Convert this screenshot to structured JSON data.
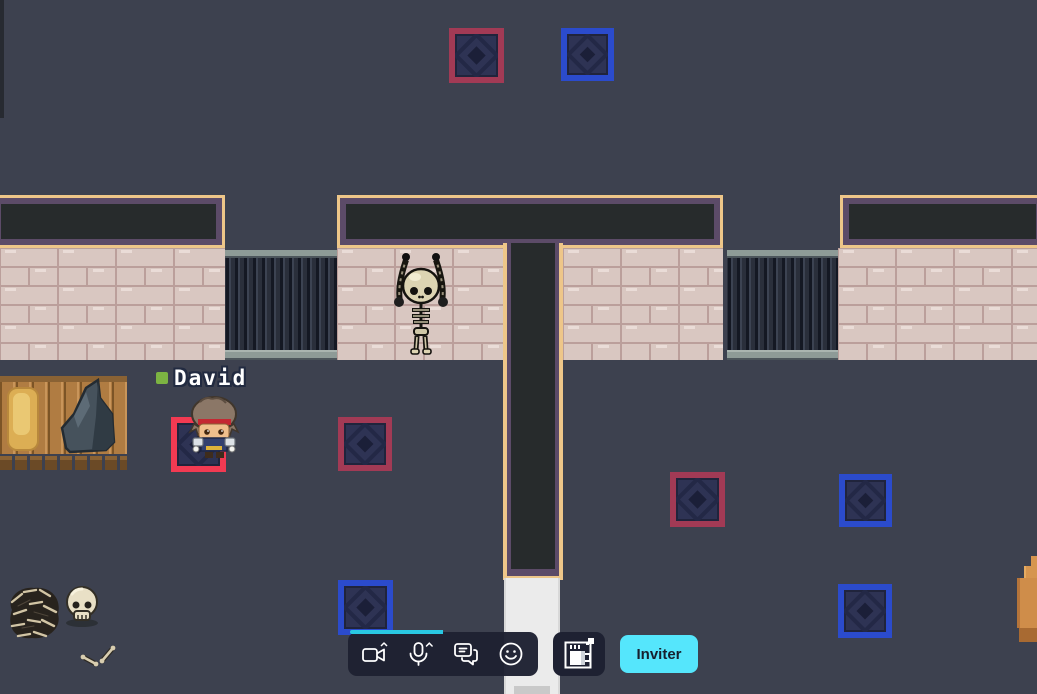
{
  "scene": {
    "background_color": "#3d414f",
    "player": {
      "name": "David",
      "presence_color": "#7cb342"
    },
    "tile_colors": {
      "red": "#a23a55",
      "blue": "#2b4bcc",
      "active": "#f23a52"
    },
    "tiles": [
      {
        "x": 449,
        "y": 28,
        "size": 55,
        "variant": "red"
      },
      {
        "x": 561,
        "y": 28,
        "size": 53,
        "variant": "blue"
      },
      {
        "x": 171,
        "y": 417,
        "size": 55,
        "variant": "active"
      },
      {
        "x": 338,
        "y": 417,
        "size": 54,
        "variant": "red"
      },
      {
        "x": 670,
        "y": 472,
        "size": 55,
        "variant": "red"
      },
      {
        "x": 839,
        "y": 474,
        "size": 53,
        "variant": "blue"
      },
      {
        "x": 338,
        "y": 580,
        "size": 55,
        "variant": "blue"
      },
      {
        "x": 838,
        "y": 584,
        "size": 54,
        "variant": "blue"
      }
    ],
    "decorations": [
      "hanging-skeleton",
      "wood-table",
      "hay-bale",
      "rock-pile",
      "bone-pile",
      "skull",
      "scattered-bones",
      "crate-edge"
    ]
  },
  "toolbar": {
    "accent_color": "#29c8e2",
    "icons": [
      {
        "name": "camera"
      },
      {
        "name": "microphone"
      },
      {
        "name": "chat"
      },
      {
        "name": "emoji"
      }
    ],
    "coffee_button": {
      "icon": "coffee-break"
    },
    "invite_button": {
      "label": "Inviter",
      "bg": "#55e6fc",
      "text_color": "#17202e"
    }
  }
}
